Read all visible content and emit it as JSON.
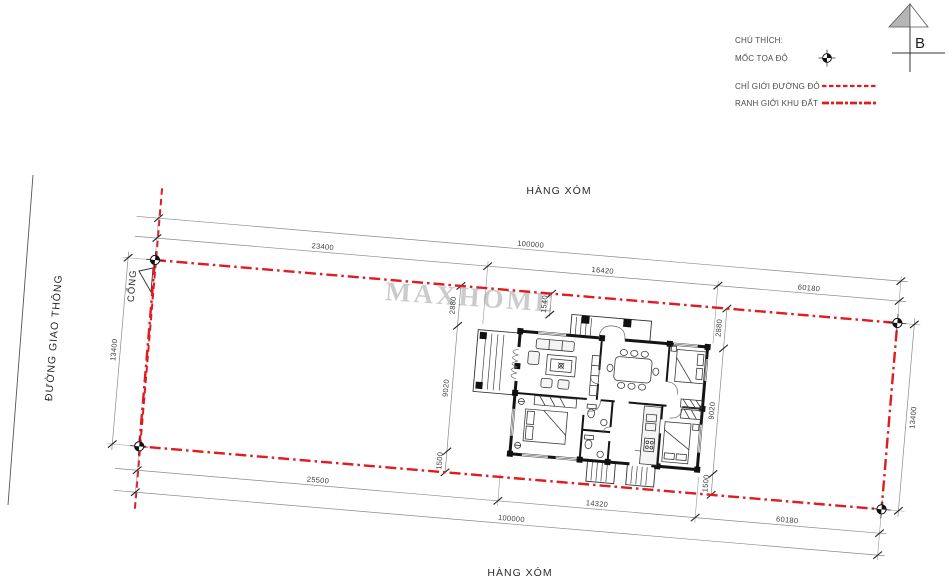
{
  "legend": {
    "title": "CHÚ THÍCH:",
    "marker_label": "MỐC TỌA ĐỘ",
    "red_line_label": "CHỈ GIỚI ĐƯỜNG ĐỎ",
    "boundary_label": "RANH GIỚI KHU ĐẤT"
  },
  "north_arrow": {
    "label": "B"
  },
  "labels": {
    "neighbor_top": "HÀNG XÓM",
    "neighbor_bottom": "HÀNG XÓM",
    "road": "ĐƯỜNG GIAO THÔNG",
    "gate": "CỔNG",
    "watermark": "MAXHOME"
  },
  "dimensions": {
    "top_total": "100000",
    "top_segment_1": "23400",
    "top_segment_2": "16420",
    "top_segment_3": "60180",
    "bottom_total": "100000",
    "bottom_segment_1": "25500",
    "bottom_segment_2": "14320",
    "bottom_segment_3": "60180",
    "left_width": "13400",
    "right_width": "13400",
    "left_front_setback": "2880",
    "left_house_depth": "9020",
    "left_rear_setback": "1500",
    "right_front_setback": "2880",
    "right_house_depth": "9020",
    "right_rear_setback": "1500",
    "porch_setback": "1540"
  },
  "colors": {
    "boundary_red": "#e01b22",
    "dim_line_gray": "#8a8a8a",
    "wall_black": "#141414",
    "text_gray": "#3d3d3d",
    "watermark_gray": "#c9c9c9"
  }
}
